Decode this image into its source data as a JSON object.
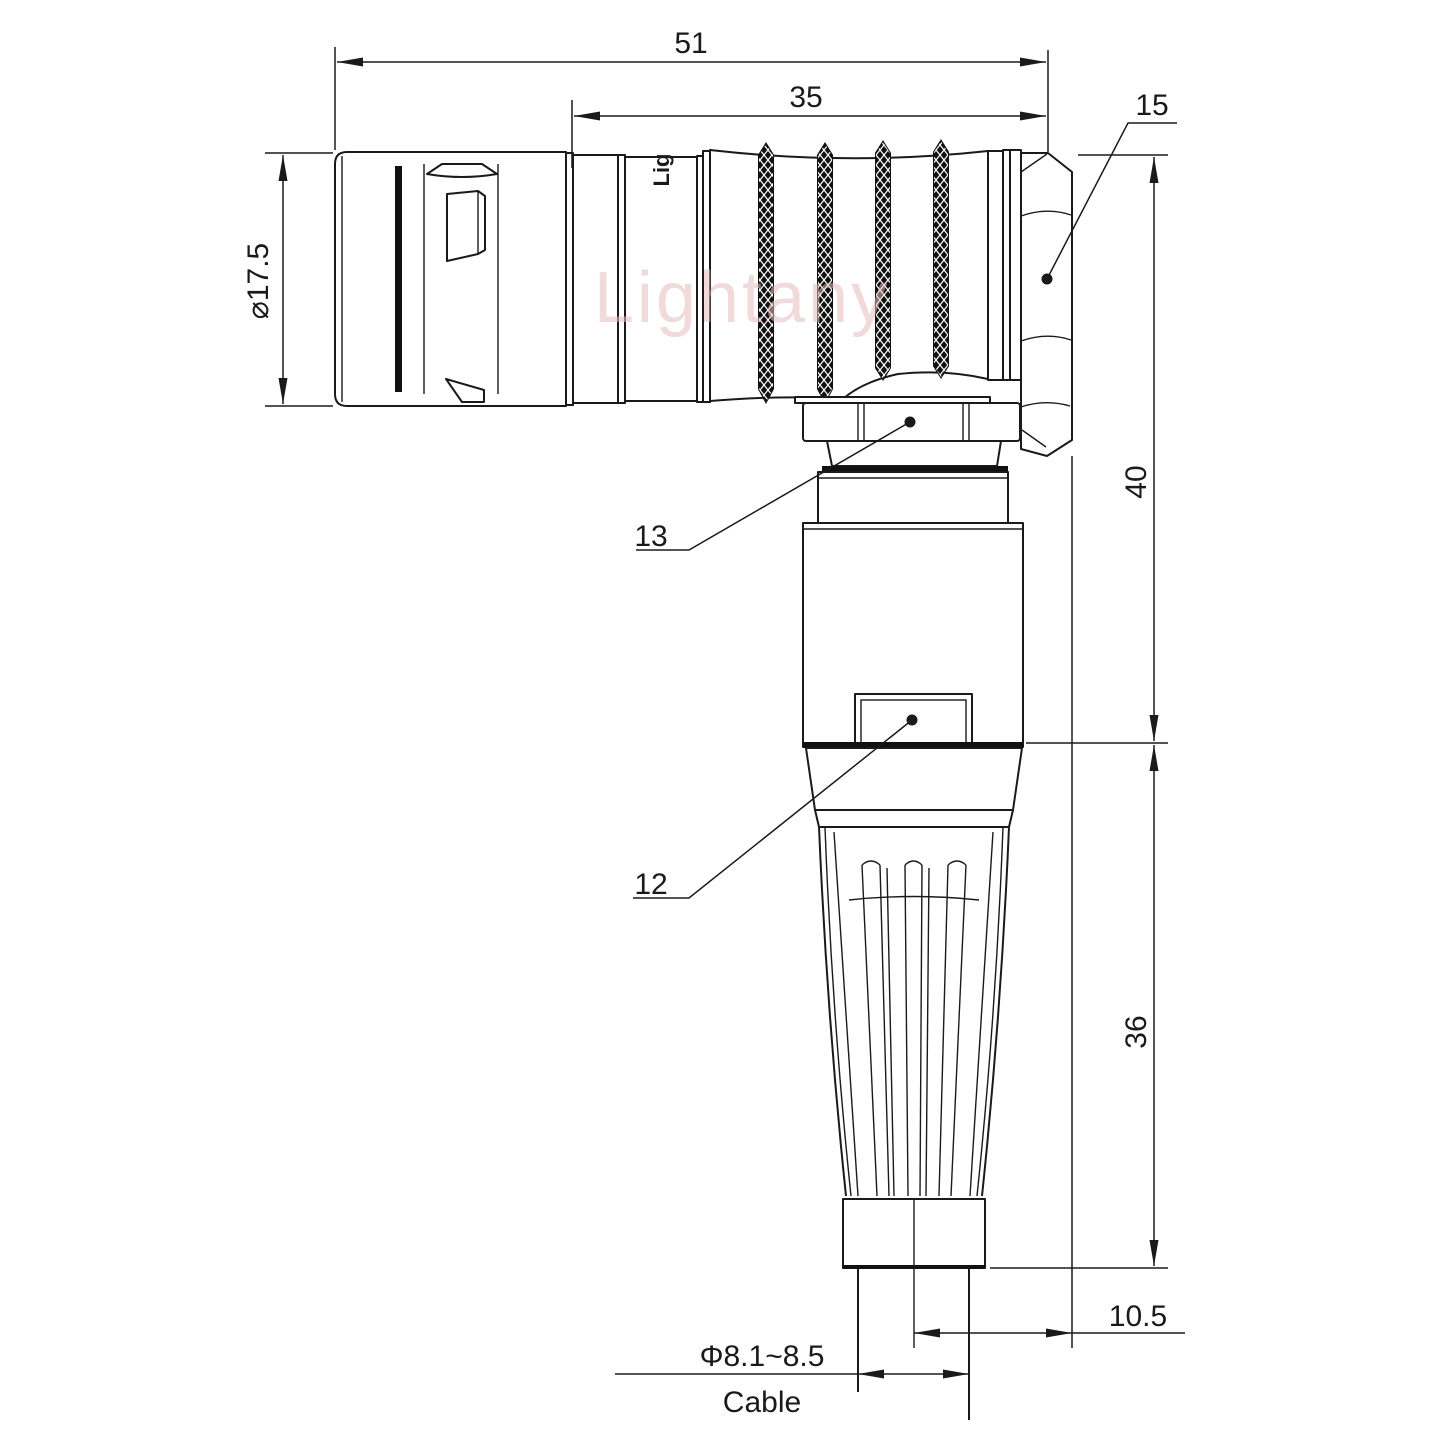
{
  "drawing": {
    "title": "Right-angle connector dimensional drawing",
    "watermark": "Lightany",
    "body_mark": "Lig",
    "dimensions": {
      "overall_length": "51",
      "grip_length": "35",
      "plug_diameter": "⌀17.5",
      "elbow_height": "40",
      "boot_height": "36",
      "cable_offset": "10.5",
      "cable_diameter": "Φ8.1~8.5",
      "cable_label": "Cable"
    },
    "parts": {
      "hex_nut_item": "15",
      "coupling_nut_item": "13",
      "housing_item": "12"
    },
    "colors": {
      "line": "#1a1a1a",
      "watermark": "#e5bcbc",
      "background": "#ffffff"
    }
  }
}
